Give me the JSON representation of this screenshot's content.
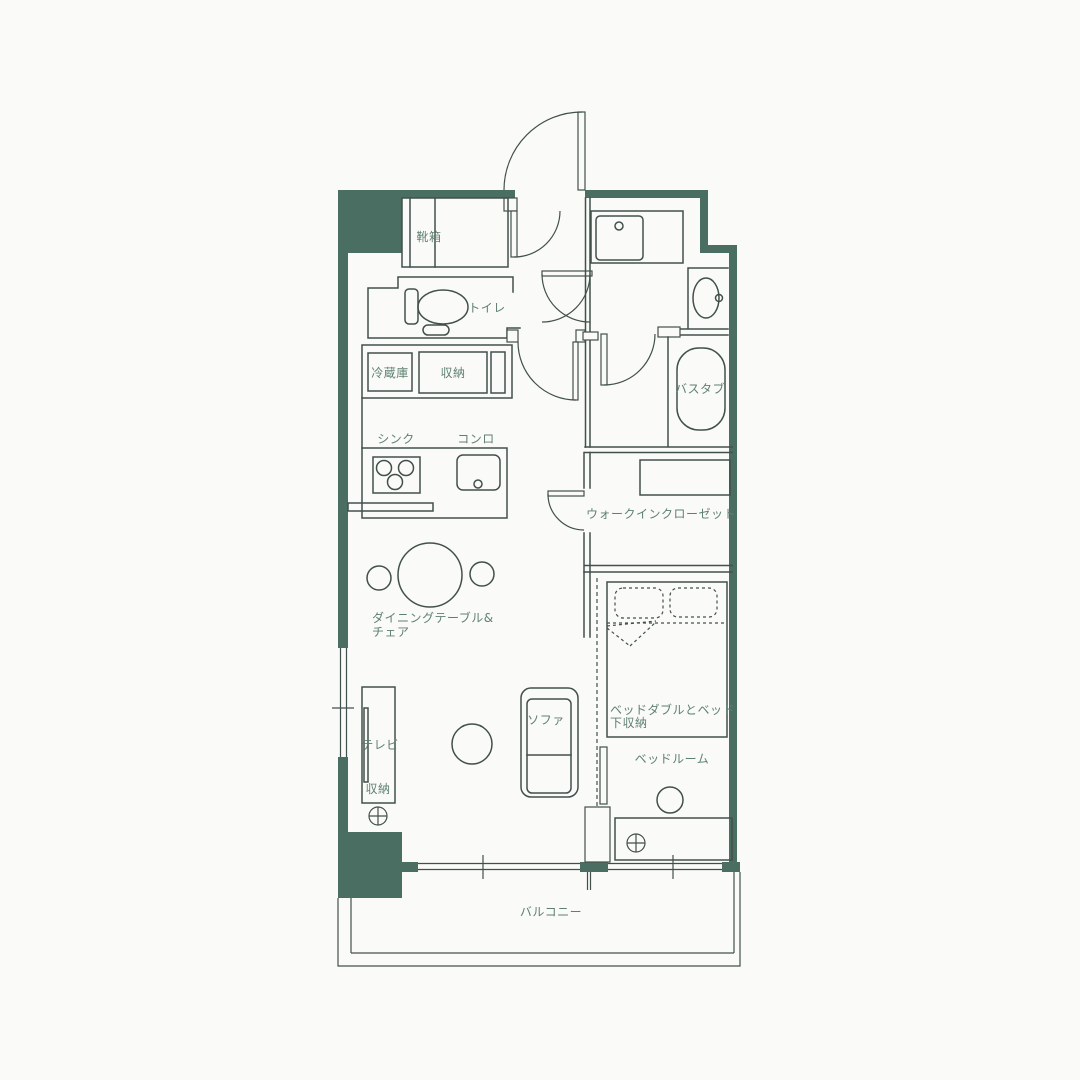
{
  "colors": {
    "wall": "#4b6e62",
    "line": "#42504b",
    "label": "#5e8072",
    "paper": "#fafaf8"
  },
  "plan": {
    "labels": {
      "shoe_cabinet": "靴箱",
      "toilet": "トイレ",
      "refrigerator": "冷蔵庫",
      "kitchen_storage": "収納",
      "sink": "シンク",
      "stove": "コンロ",
      "bathtub": "バスタブ",
      "walk_in_closet": "ウォークインクローゼット",
      "dining_line1": "ダイニングテーブル&",
      "dining_line2": "チェア",
      "tv": "テレビ",
      "tv_storage": "収納",
      "sofa": "ソファ",
      "bed_line1": "ベッドダブルとベッド",
      "bed_line2": "下収納",
      "bedroom": "ベッドルーム",
      "balcony": "バルコニー"
    }
  }
}
